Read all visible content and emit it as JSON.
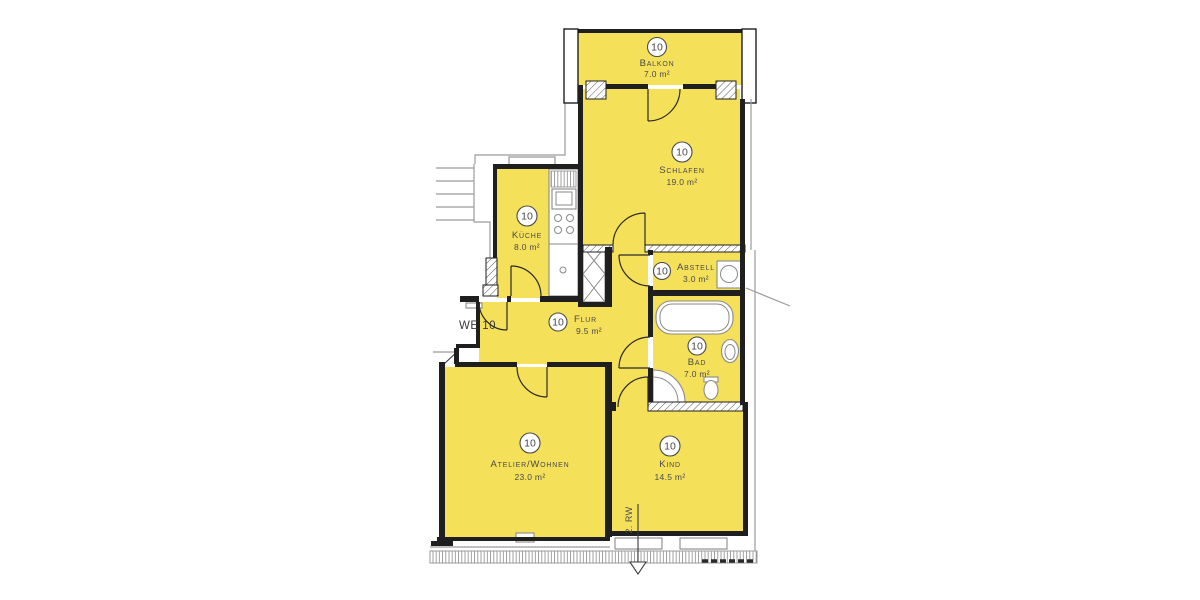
{
  "plan": {
    "apartment_label": "WE 10",
    "escape_route_label": "2. RW",
    "colors": {
      "room_fill": "#F5E05A",
      "wall": "#1F1F1F",
      "fixture_stroke": "#8A8A8A",
      "text": "#4A4A4A",
      "outline": "#9B9B9B"
    },
    "rooms": {
      "balkon": {
        "number": "10",
        "name": "Balkon",
        "area": "7.0 m²"
      },
      "schlafen": {
        "number": "10",
        "name": "Schlafen",
        "area": "19.0 m²"
      },
      "kueche": {
        "number": "10",
        "name": "Küche",
        "area": "8.0 m²"
      },
      "abstell": {
        "number": "10",
        "name": "Abstell",
        "area": "3.0 m²"
      },
      "flur": {
        "number": "10",
        "name": "Flur",
        "area": "9.5 m²"
      },
      "bad": {
        "number": "10",
        "name": "Bad",
        "area": "7.0 m²"
      },
      "atelier_wohnen": {
        "number": "10",
        "name": "Atelier/Wohnen",
        "area": "23.0 m²"
      },
      "kind": {
        "number": "10",
        "name": "Kind",
        "area": "14.5 m²"
      }
    }
  }
}
